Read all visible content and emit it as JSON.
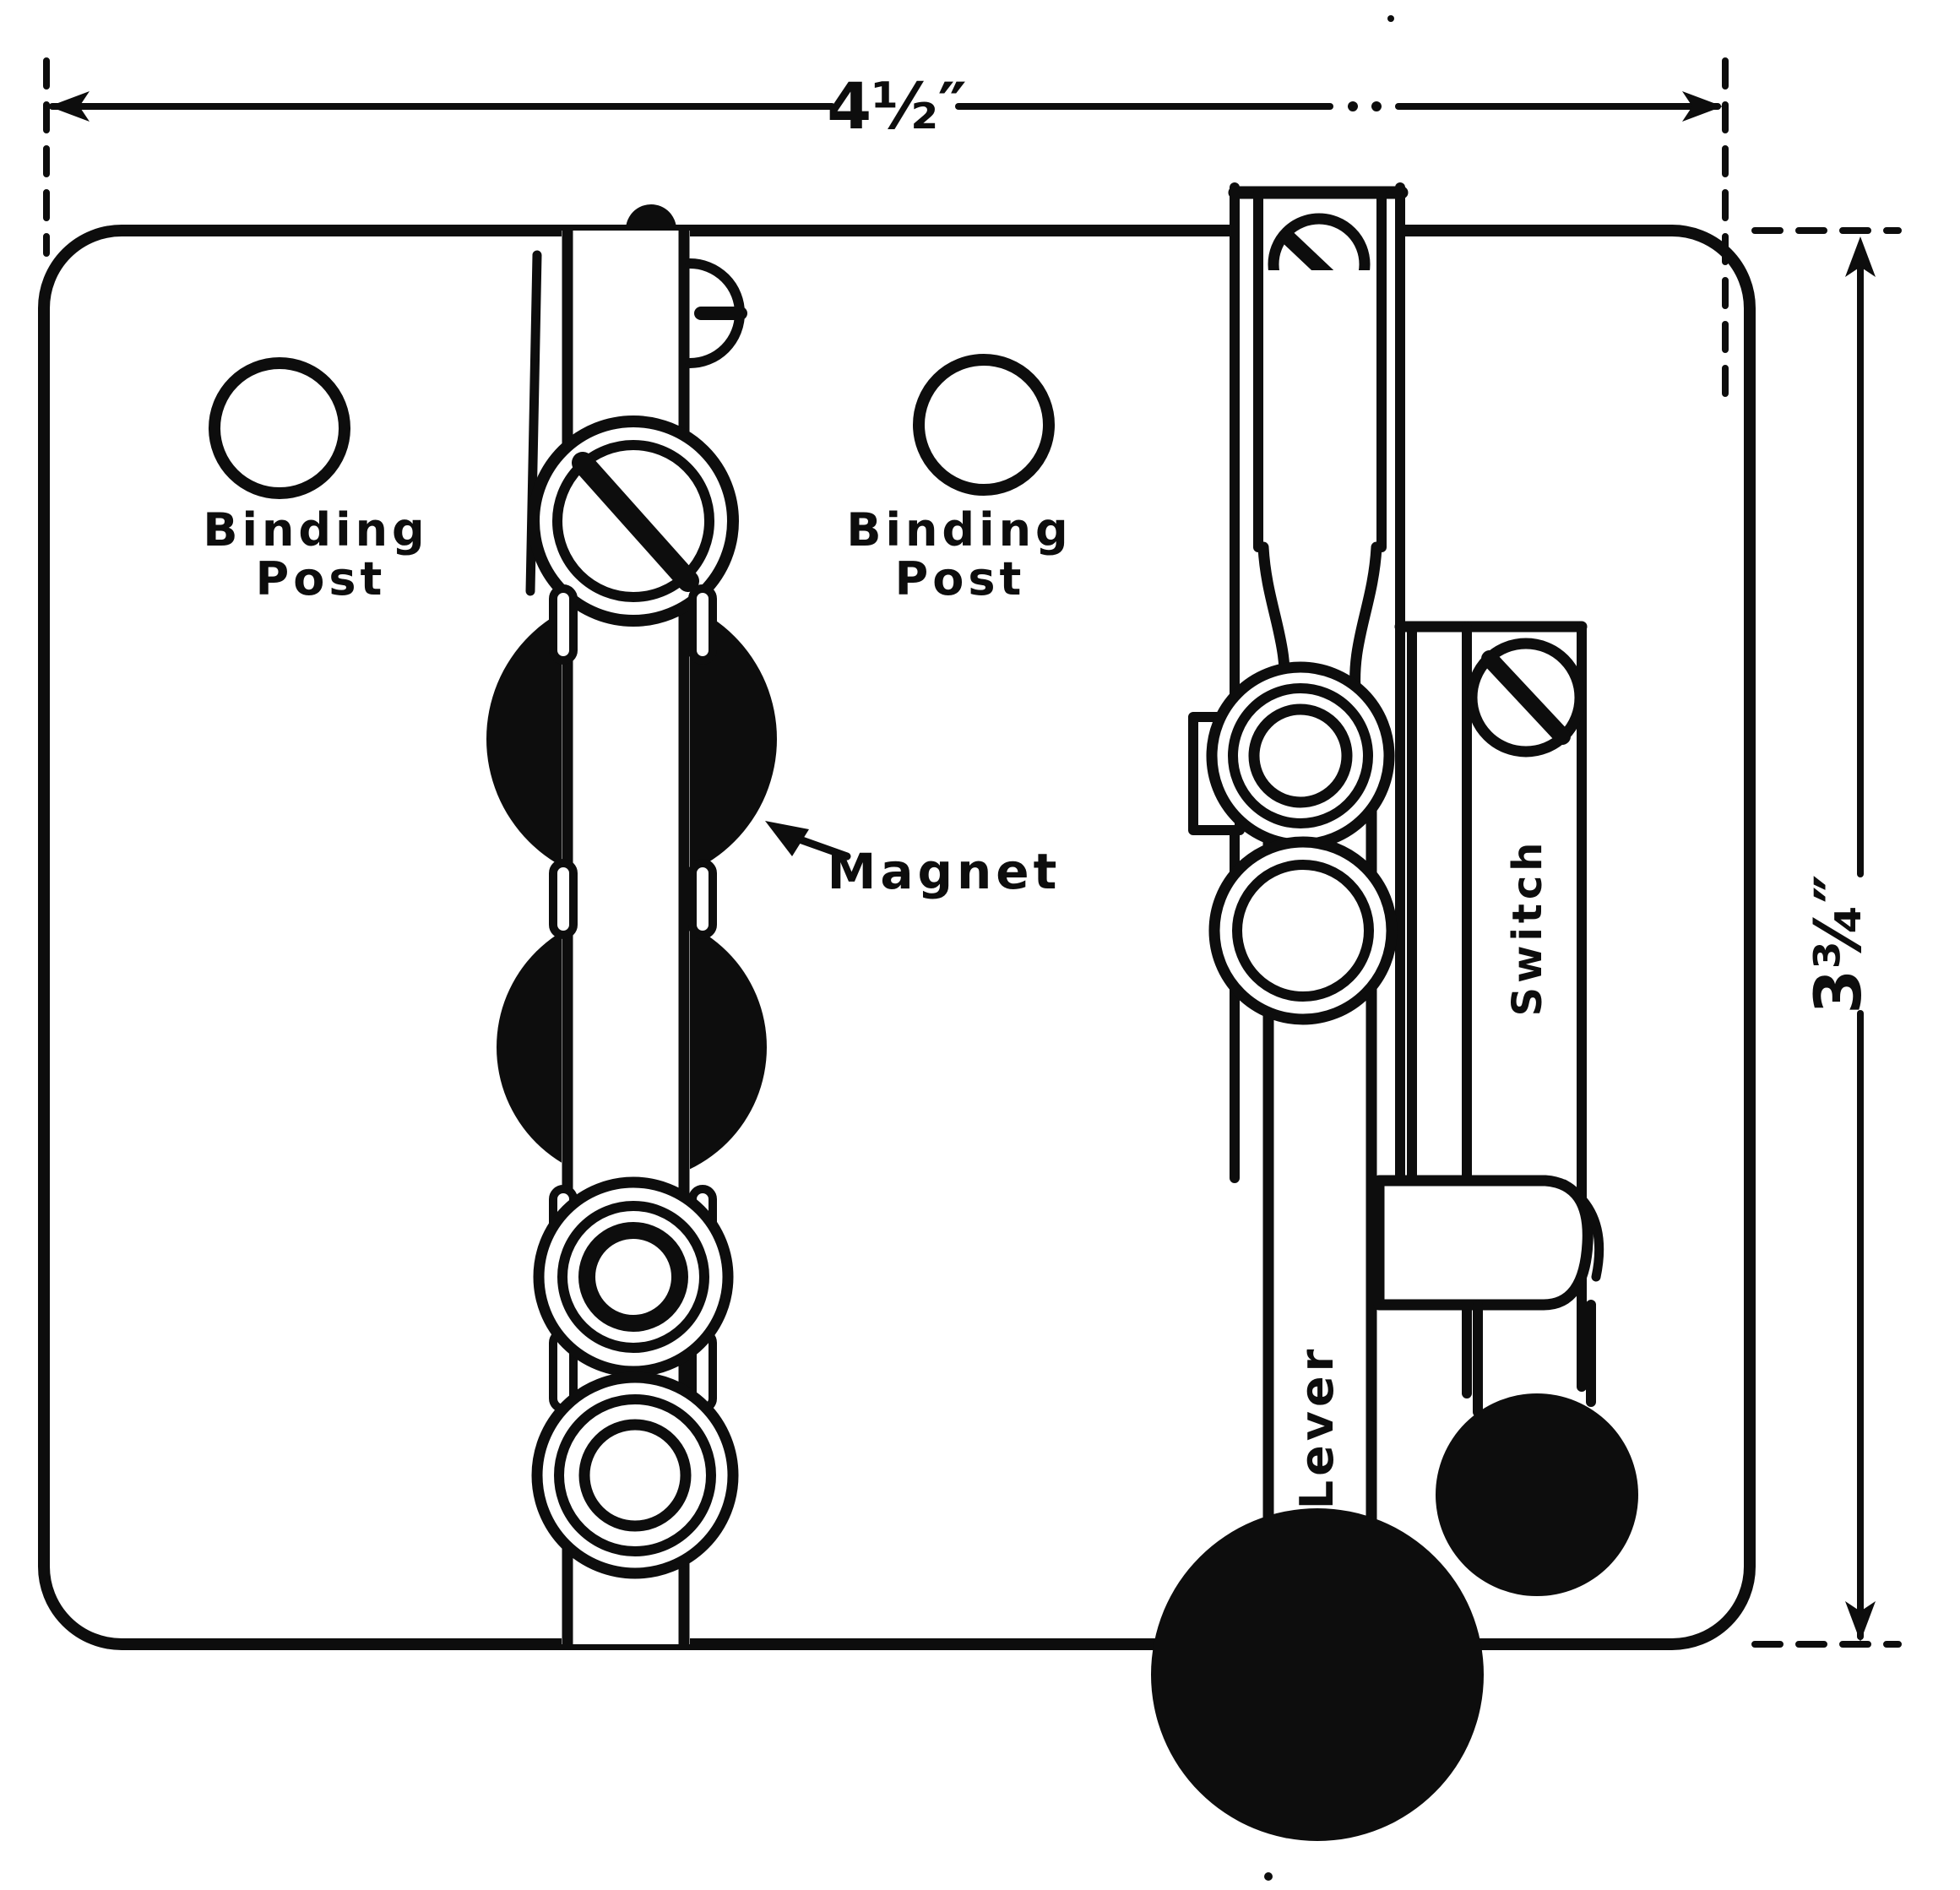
{
  "figure": {
    "paper_color": "#ffffff",
    "ink_color": "#0d0d0d",
    "dimensions": {
      "width_label": "4½″",
      "height_label": "3¾″"
    },
    "labels": {
      "binding_post_left": {
        "line1": "Binding",
        "line2": "Post"
      },
      "binding_post_right": {
        "line1": "Binding",
        "line2": "Post"
      },
      "magnet": "Magnet",
      "lever": "Lever",
      "switch": "Switch"
    }
  }
}
